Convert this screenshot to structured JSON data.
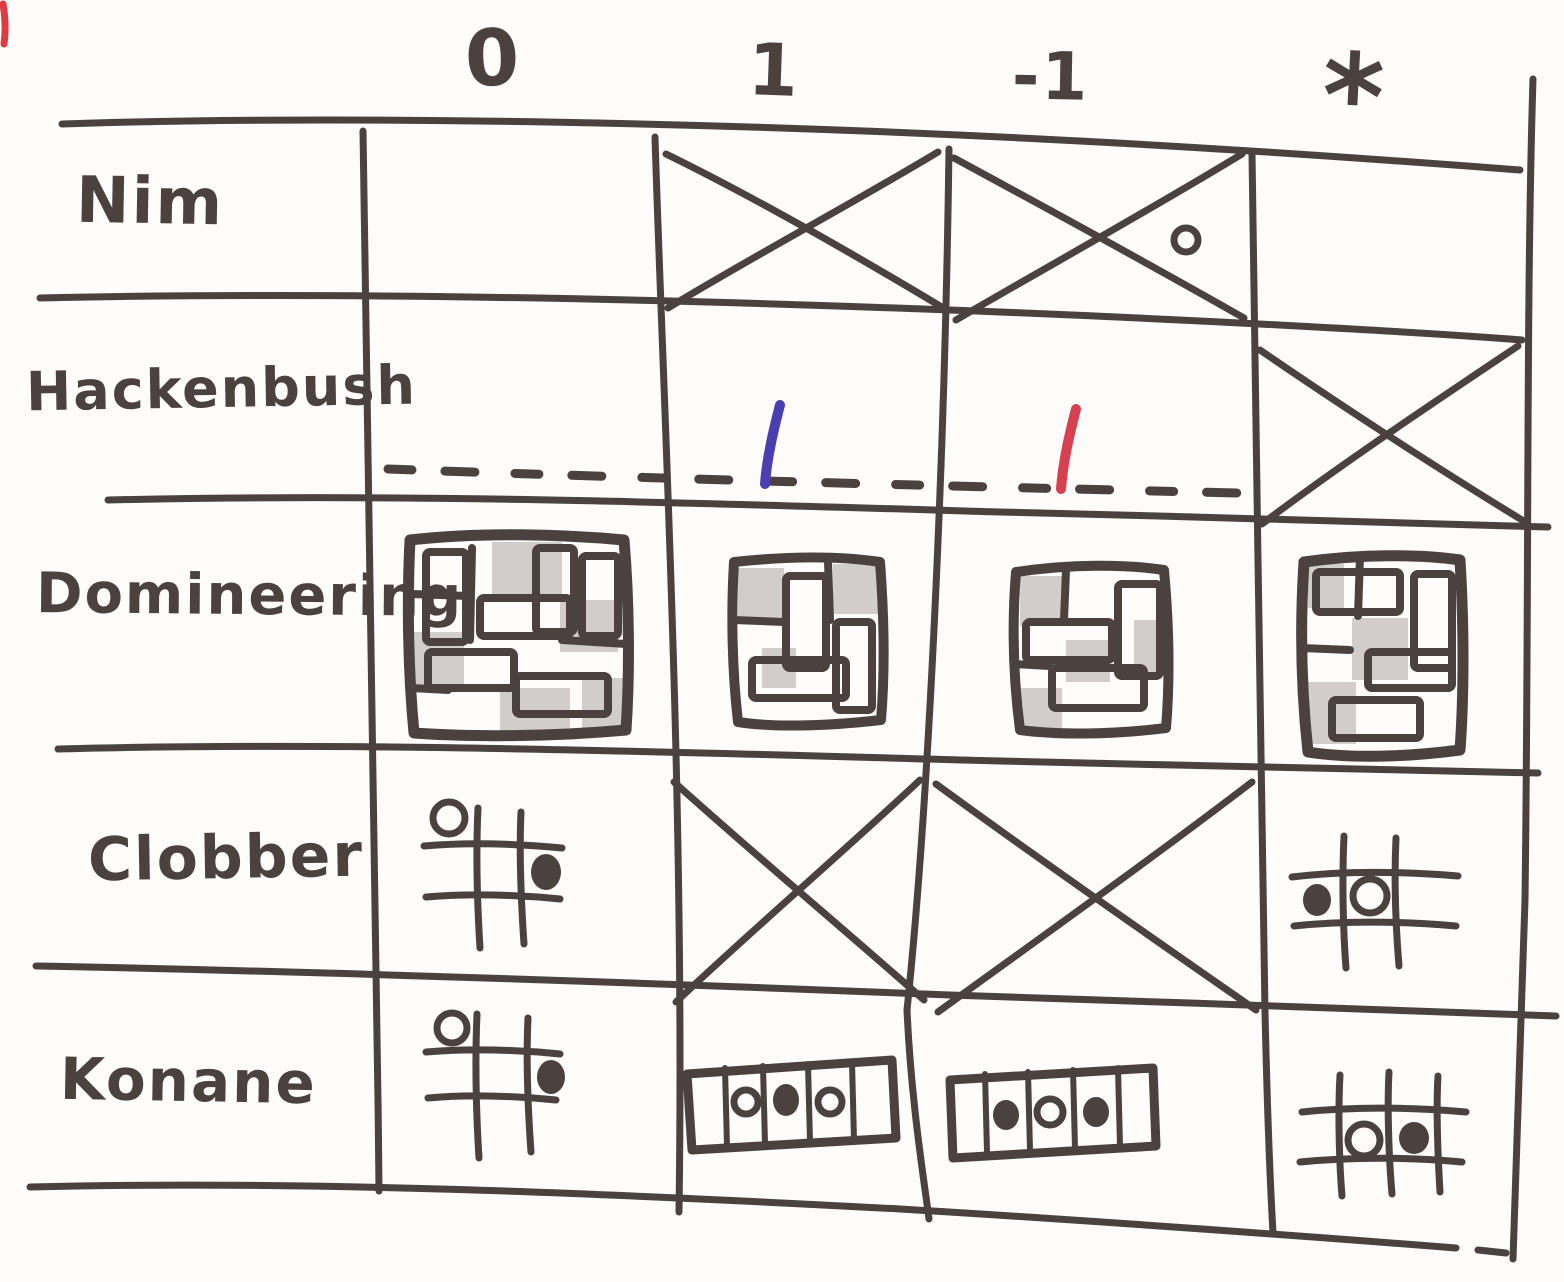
{
  "colors": {
    "ink": "#4b4240",
    "paper": "#fdfcfa",
    "shade": "#a89e99",
    "blue": "#4a3fb0",
    "red": "#d74050"
  },
  "table": {
    "description": "Hand-drawn table of combinatorial games versus game values",
    "columns": [
      {
        "label": "0"
      },
      {
        "label": "1"
      },
      {
        "label": "-1"
      },
      {
        "label": "*"
      }
    ],
    "rows": [
      {
        "label": "Nim",
        "cells": [
          "empty",
          "crossed-out",
          "crossed-out",
          "small-white-stone"
        ]
      },
      {
        "label": "Hackenbush",
        "cells": [
          "dashed-ground-empty",
          "blue-edge-on-dashed-ground",
          "red-edge-on-dashed-ground",
          "crossed-out"
        ]
      },
      {
        "label": "Domineering",
        "cells": [
          "board-4x4-with-dominoes-and-shading",
          "board-3x3-with-dominoes-and-shading",
          "board-3x3-with-dominoes-and-shading",
          "board-3x3-with-dominoes-and-shading"
        ]
      },
      {
        "label": "Clobber",
        "cells": [
          "grid-white-stone-top-left-black-stone-middle-right",
          "crossed-out",
          "crossed-out",
          "grid-black-stone-left-white-stone-center"
        ]
      },
      {
        "label": "Konane",
        "cells": [
          "grid-white-stone-top-left-black-stone-middle-right",
          "strip-stones-white-black-white",
          "strip-stones-black-white-black",
          "grid-white-stone-and-black-stone-middle-row"
        ]
      }
    ]
  }
}
